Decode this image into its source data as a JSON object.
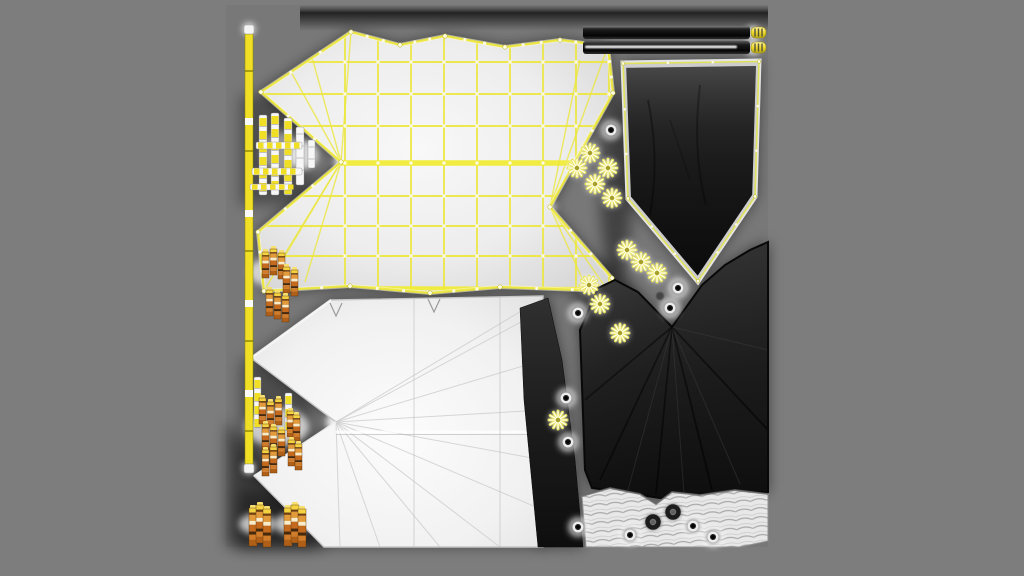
{
  "colors": {
    "page_bg": "#7d7d7d",
    "atlas_bg": "#787878",
    "wire_yellow": "#ece73c",
    "wire_thick": "#f1ec2e",
    "vertex_dot": "#fdfbe0",
    "fabric_light": "#efefef",
    "fabric_dark": "#161616",
    "banner_band": "#cdcdcd",
    "pole_yellow": "#f0df25",
    "pole_white": "#f7f7f7",
    "peg_orange": "#cf7a28",
    "peg_cap": "#f4d343",
    "glow_white": "#ffffff",
    "trim_light": "#e8e8e8",
    "bar_dark": "#1b1b1b",
    "bar_stripe": "#f5f5f5",
    "cap_yellow": "#ecdf2e"
  },
  "atlas": {
    "x": 226,
    "y": 5,
    "size": 542
  },
  "canopy_top": {
    "outline": [
      [
        351,
        32
      ],
      [
        400,
        45
      ],
      [
        445,
        36
      ],
      [
        505,
        47
      ],
      [
        560,
        40
      ],
      [
        608,
        46
      ],
      [
        613,
        93
      ],
      [
        550,
        207
      ],
      [
        612,
        278
      ],
      [
        608,
        291
      ],
      [
        500,
        287
      ],
      [
        430,
        293
      ],
      [
        350,
        286
      ],
      [
        264,
        291
      ],
      [
        258,
        232
      ],
      [
        341,
        162
      ],
      [
        261,
        92
      ]
    ],
    "grid_x": {
      "from": 345,
      "to": 612,
      "step": 33
    },
    "grid_y": [
      62,
      94,
      126,
      163,
      196,
      226,
      256
    ],
    "thick_fold_y": 163,
    "left_tip": [
      341,
      162
    ],
    "left_fan_targets": [
      [
        261,
        92
      ],
      [
        258,
        232
      ],
      [
        264,
        120
      ],
      [
        262,
        200
      ],
      [
        290,
        70
      ],
      [
        280,
        262
      ],
      [
        310,
        50
      ],
      [
        305,
        282
      ],
      [
        351,
        32
      ],
      [
        264,
        291
      ]
    ],
    "right_tip": [
      550,
      207
    ],
    "right_fan_targets": [
      [
        613,
        93
      ],
      [
        612,
        278
      ],
      [
        608,
        46
      ],
      [
        608,
        291
      ],
      [
        610,
        130
      ],
      [
        610,
        240
      ],
      [
        580,
        60
      ],
      [
        585,
        285
      ]
    ]
  },
  "banner": {
    "outline": [
      [
        622,
        62
      ],
      [
        760,
        60
      ],
      [
        756,
        197
      ],
      [
        698,
        283
      ],
      [
        627,
        199
      ]
    ]
  },
  "bars": {
    "x": 583,
    "width": 167,
    "bar1_y": 26,
    "bar2_y": 41,
    "height": 13,
    "stripe_x": 585,
    "stripe_w": 152,
    "stripe_y": 45.5,
    "stripe_h": 2.8,
    "caps": [
      [
        751,
        27
      ],
      [
        751,
        42
      ]
    ],
    "cap_w": 15,
    "cap_h": 11
  },
  "canopy_bottom": {
    "outline": [
      [
        331,
        300
      ],
      [
        543,
        296
      ],
      [
        543,
        547
      ],
      [
        324,
        547
      ],
      [
        254,
        476
      ],
      [
        336,
        422
      ],
      [
        251,
        358
      ]
    ],
    "tip": [
      336,
      422
    ],
    "fan_targets": [
      [
        543,
        310
      ],
      [
        543,
        360
      ],
      [
        543,
        410
      ],
      [
        543,
        460
      ],
      [
        543,
        510
      ],
      [
        500,
        547
      ],
      [
        440,
        547
      ],
      [
        380,
        547
      ],
      [
        340,
        547
      ],
      [
        543,
        298
      ]
    ],
    "crease_y": 432,
    "seams_x": [
      414,
      500
    ],
    "notches": [
      [
        336,
        303
      ],
      [
        434,
        299
      ]
    ]
  },
  "dark_wedge": [
    [
      520,
      308
    ],
    [
      548,
      298
    ],
    [
      562,
      360
    ],
    [
      575,
      460
    ],
    [
      583,
      547
    ],
    [
      538,
      547
    ],
    [
      524,
      400
    ]
  ],
  "dark_canopy": {
    "outline": [
      [
        585,
        470
      ],
      [
        580,
        330
      ],
      [
        598,
        288
      ],
      [
        615,
        280
      ],
      [
        638,
        292
      ],
      [
        672,
        327
      ],
      [
        702,
        285
      ],
      [
        725,
        265
      ],
      [
        750,
        250
      ],
      [
        768,
        242
      ],
      [
        768,
        492
      ],
      [
        700,
        494
      ],
      [
        660,
        498
      ],
      [
        620,
        492
      ],
      [
        592,
        488
      ]
    ],
    "valley_tip": [
      672,
      327
    ],
    "fan_targets": [
      [
        600,
        480
      ],
      [
        628,
        490
      ],
      [
        656,
        494
      ],
      [
        684,
        494
      ],
      [
        712,
        490
      ],
      [
        740,
        484
      ],
      [
        768,
        430
      ],
      [
        768,
        350
      ],
      [
        585,
        400
      ]
    ]
  },
  "trim_strip": {
    "outline": [
      [
        586,
        547
      ],
      [
        582,
        496
      ],
      [
        610,
        488
      ],
      [
        640,
        494
      ],
      [
        656,
        504
      ],
      [
        672,
        492
      ],
      [
        700,
        495
      ],
      [
        735,
        490
      ],
      [
        768,
        494
      ],
      [
        768,
        541
      ],
      [
        740,
        547
      ]
    ]
  },
  "poles": {
    "main": {
      "x": 245,
      "y": 25,
      "w": 8,
      "h": 448
    },
    "cluster": [
      {
        "x": 259,
        "y": 115,
        "w": 8,
        "h": 80,
        "style": "striped"
      },
      {
        "x": 271,
        "y": 113,
        "w": 8,
        "h": 82,
        "style": "striped"
      },
      {
        "x": 284,
        "y": 118,
        "w": 8,
        "h": 77,
        "style": "striped"
      },
      {
        "x": 296,
        "y": 127,
        "w": 8,
        "h": 58,
        "style": "white"
      },
      {
        "x": 308,
        "y": 140,
        "w": 7,
        "h": 28,
        "style": "white"
      },
      {
        "x": 254,
        "y": 377,
        "w": 7,
        "h": 47,
        "style": "striped"
      },
      {
        "x": 285,
        "y": 393,
        "w": 7,
        "h": 45,
        "style": "striped"
      }
    ],
    "hbars": [
      {
        "x": 256,
        "y": 142,
        "w": 46,
        "h": 7
      },
      {
        "x": 252,
        "y": 168,
        "w": 50,
        "h": 7
      },
      {
        "x": 250,
        "y": 184,
        "w": 42,
        "h": 6
      }
    ]
  },
  "pegs": {
    "size": {
      "w": 7,
      "h": 26
    },
    "bottom_size": {
      "w": 8,
      "h": 38
    },
    "clusters": [
      {
        "glow": [
          275,
          272,
          26
        ],
        "items": [
          [
            262,
            252
          ],
          [
            270,
            249
          ],
          [
            278,
            253
          ],
          [
            283,
            267
          ],
          [
            291,
            270
          ],
          [
            266,
            290
          ],
          [
            274,
            293
          ],
          [
            282,
            296
          ]
        ]
      },
      {
        "glow": [
          277,
          427,
          32
        ],
        "items": [
          [
            259,
            398
          ],
          [
            267,
            402
          ],
          [
            275,
            399
          ],
          [
            262,
            424
          ],
          [
            270,
            427
          ],
          [
            278,
            430
          ],
          [
            287,
            411
          ],
          [
            293,
            415
          ],
          [
            288,
            440
          ],
          [
            295,
            444
          ],
          [
            270,
            447
          ],
          [
            262,
            450
          ]
        ]
      }
    ],
    "bottom_bundles": [
      {
        "glow": [
          257,
          524,
          18
        ],
        "items": [
          [
            249,
            508
          ],
          [
            256,
            505
          ],
          [
            263,
            509
          ]
        ]
      },
      {
        "glow": [
          292,
          524,
          18
        ],
        "items": [
          [
            284,
            508
          ],
          [
            291,
            505
          ],
          [
            298,
            509
          ]
        ]
      }
    ]
  },
  "stars": [
    [
      590,
      153
    ],
    [
      577,
      168
    ],
    [
      608,
      168
    ],
    [
      595,
      184
    ],
    [
      612,
      198
    ],
    [
      627,
      250
    ],
    [
      641,
      262
    ],
    [
      657,
      273
    ],
    [
      589,
      285
    ],
    [
      600,
      304
    ],
    [
      620,
      333
    ],
    [
      558,
      420
    ]
  ],
  "grommets": {
    "halo": [
      [
        611,
        130
      ],
      [
        678,
        288
      ],
      [
        670,
        308
      ],
      [
        578,
        313
      ],
      [
        566,
        398
      ],
      [
        568,
        442
      ],
      [
        578,
        527
      ],
      [
        630,
        535
      ],
      [
        693,
        526
      ],
      [
        713,
        537
      ]
    ],
    "dark": [
      [
        653,
        522
      ],
      [
        673,
        512
      ]
    ],
    "faint": [
      [
        660,
        296
      ]
    ]
  },
  "extra_glows": [
    [
      341,
      162,
      7,
      0.9
    ],
    [
      336,
      422,
      10,
      0.9
    ],
    [
      550,
      207,
      6,
      0.7
    ],
    [
      249,
      29,
      6,
      0.9
    ],
    [
      249,
      468,
      6,
      0.9
    ],
    [
      753,
      33,
      7,
      0.8
    ],
    [
      753,
      48,
      7,
      0.8
    ],
    [
      303,
      155,
      15,
      0.75
    ],
    [
      281,
      152,
      20,
      0.4
    ]
  ],
  "shadow_rects": [
    [
      240,
      95,
      72,
      110,
      0.35
    ],
    [
      240,
      360,
      72,
      120,
      0.35
    ],
    [
      238,
      490,
      80,
      60,
      0.4
    ]
  ],
  "shadow_ellipses": [
    [
      616,
      185,
      16,
      95,
      0.45
    ],
    [
      604,
      300,
      30,
      40,
      0.35
    ]
  ],
  "corner_shadow": [
    [
      226,
      420
    ],
    [
      330,
      547
    ],
    [
      226,
      547
    ]
  ]
}
